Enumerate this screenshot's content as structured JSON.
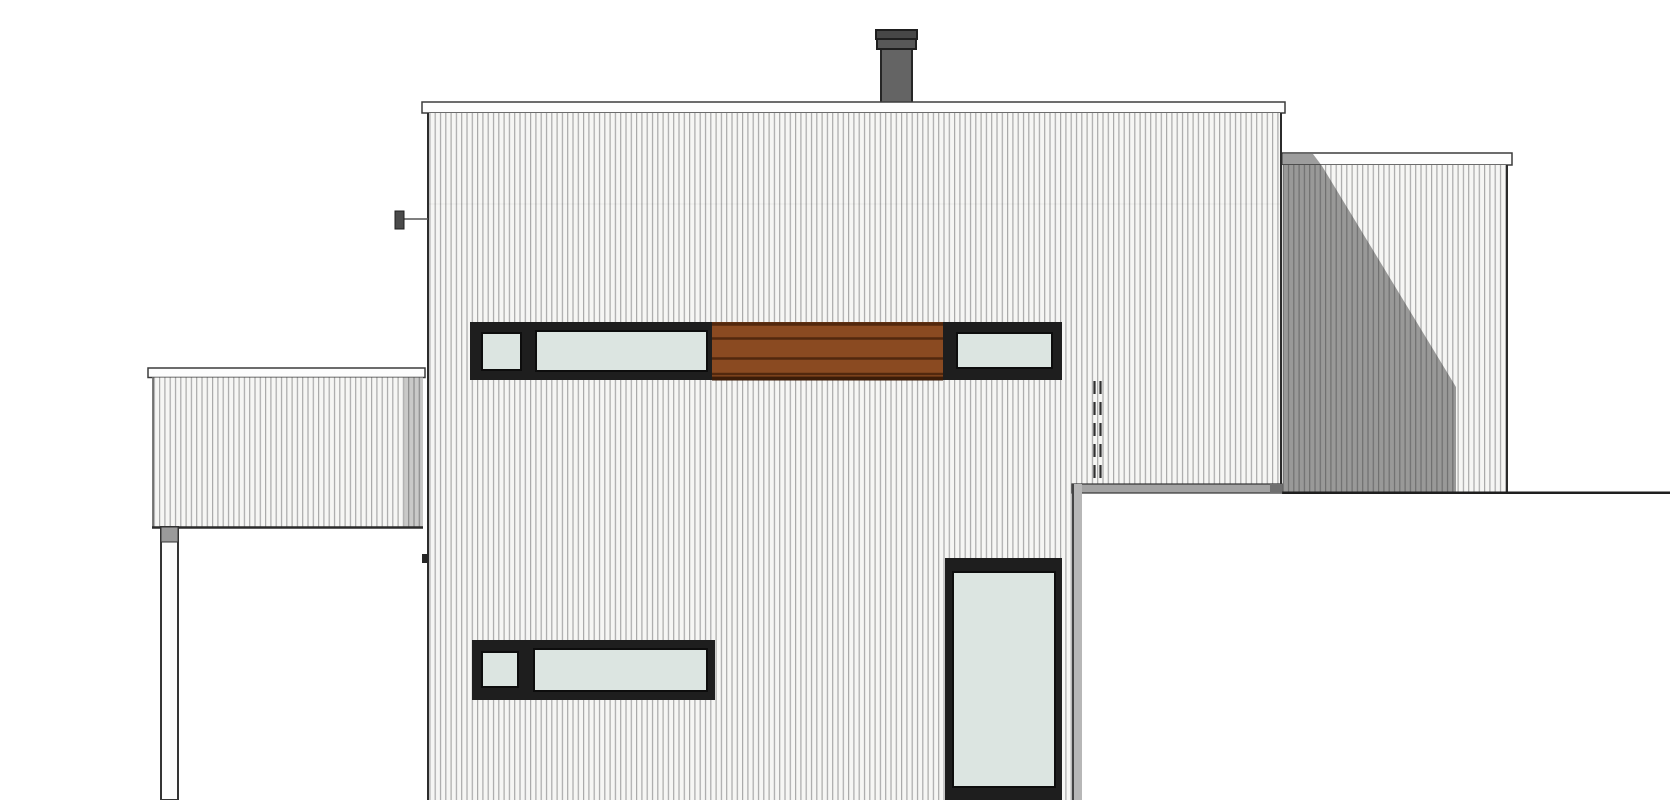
{
  "scene": {
    "label": "Architectural side elevation drawing of a modern flat-roof house with vertical siding, wood slat accent band, horizontal strip windows, chimney, side wing and carport"
  },
  "colors": {
    "background": "#ffffff",
    "siding_bg": "#f6f6f4",
    "siding_line": "#a9a9a9",
    "outline": "#2b2b2b",
    "fascia": "#fdfdfd",
    "frame_dark": "#1e1e1e",
    "glass": "#dce5e1",
    "wood_board": "#8a4a21",
    "wood_gap": "#52280e",
    "wood_base": "#3c1c08",
    "chimney_body": "#646464",
    "chimney_collar": "#585858",
    "chimney_cap": "#474747",
    "wing_shadow": "rgba(40,40,40,0.45)",
    "left_wing_shadow_strip": "rgba(0,0,0,0.18)",
    "block_top_band": "#a3a3a3",
    "block_corner": "#707070",
    "block_edge": "#b7b7b7",
    "block_face": "#ffffff",
    "post_face": "#fcfcfc",
    "post_cap": "#9a9a9a",
    "lamp": "#4a4a4a"
  }
}
